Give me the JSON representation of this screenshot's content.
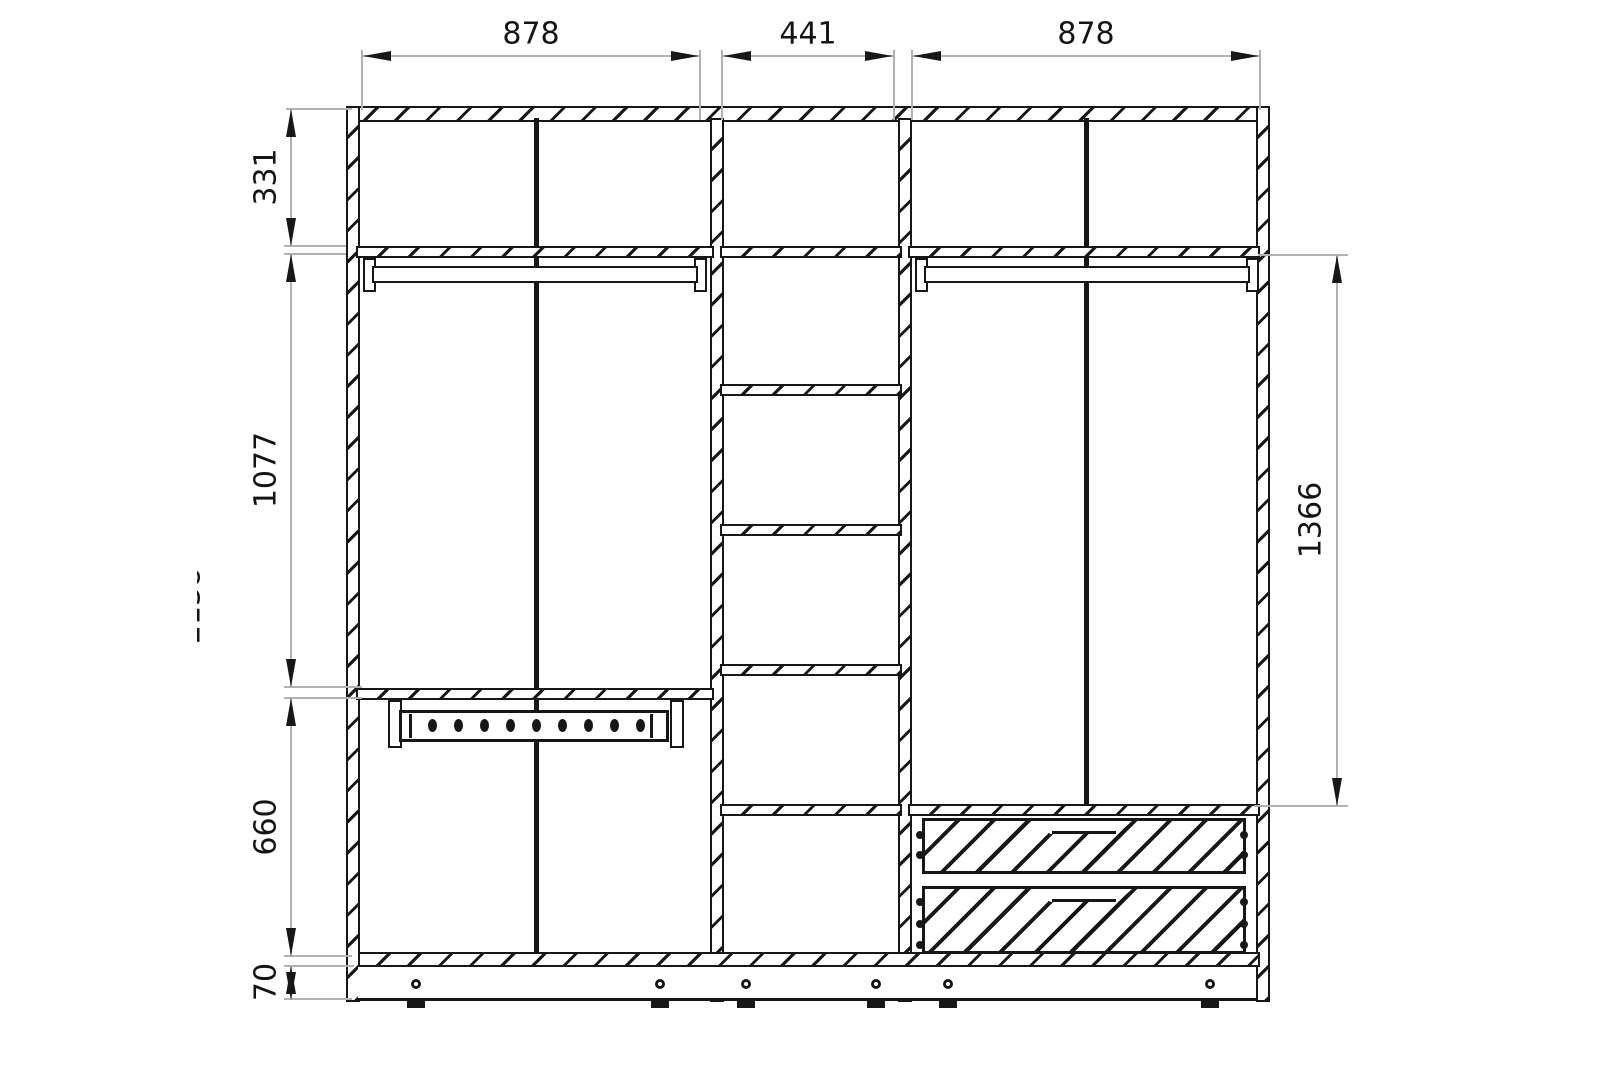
{
  "drawing": {
    "title": "Wardrobe front elevation technical drawing",
    "style": {
      "line_color": "#171717",
      "dimension_line_color": "#b2b2b2",
      "background": "#ffffff"
    },
    "dimensions": {
      "top_widths": {
        "left": "878",
        "middle": "441",
        "right": "878"
      },
      "left_heights": {
        "top_compartment": "331",
        "hanging_area": "1077",
        "lower_area": "660",
        "plinth": "70"
      },
      "right_heights": {
        "hanging_height": "1366"
      },
      "partial_overall_height": "2138"
    },
    "components": {
      "sections": 3,
      "middle_shelf_count": 5,
      "clothes_rail_count": 2,
      "trouser_rack_hole_count": 9,
      "drawer_count": 2,
      "plinth_foot_count": 6
    }
  }
}
